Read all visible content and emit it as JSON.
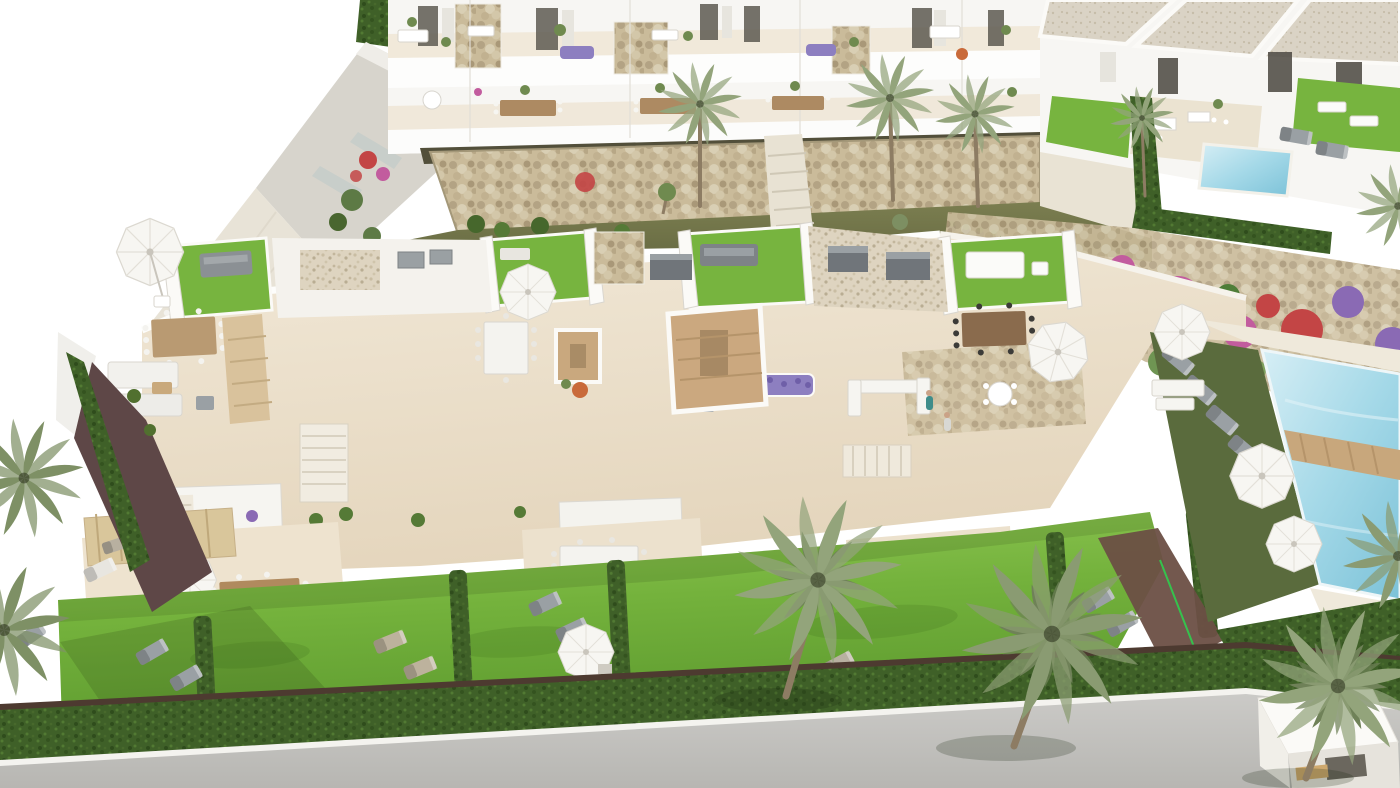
{
  "scene": {
    "title": "Aerial 3D architectural rendering of a white Mediterranean residential development with roof-terrace townhouses, an apartment block, private gardens, palm trees, parasols, sun loungers and swimming pools",
    "type": "architectural-render",
    "visible_text": []
  },
  "colors": {
    "white": "#ffffff",
    "wall": "#f7f6f3",
    "wallShade": "#d9d6cf",
    "cream": "#ecdfcb",
    "creamShade": "#e2d3ba",
    "grass": "#77b43f",
    "grassDeep": "#5f9c30",
    "olive": "#71744a",
    "oliveDark": "#5c6040",
    "gabion": "#cabb9a",
    "stone": "#cbbd9e",
    "reed": "#524f3a",
    "hedge": "#3f6028",
    "hedgeDark": "#2f4c1c",
    "palm": "#93a47b",
    "palmDark": "#6f8158",
    "trunk": "#8d7c63",
    "wood": "#c8a77c",
    "deck": "#d9c29c",
    "grey": "#90959a",
    "greyDark": "#70757a",
    "pool": "#a5d9e8",
    "poolDeep": "#7cc2d8",
    "poolLight": "#d6eef5",
    "road": "#c4c3c0",
    "roadDark": "#bdbcb8",
    "maroon": "#5e4747",
    "fuchsia": "#c25c9e",
    "red": "#c34545",
    "purple": "#8a6ab4",
    "lavender": "#8d7fc0",
    "orange": "#c96a3a",
    "soil": "#4d3a30",
    "shadow": "rgba(40,55,20,.18)"
  },
  "inventory": {
    "apartment_block": 1,
    "townhouse_roof_terrace_units": 4,
    "detached_villas": 3,
    "private_pools": 2,
    "communal_pools": 1,
    "palm_trees": 11,
    "parasols": 8,
    "sun_loungers": 18,
    "dining_sets": 8,
    "gabion_stone_walls": 2,
    "gardens": 6,
    "hedges": 10,
    "roads": 1
  }
}
